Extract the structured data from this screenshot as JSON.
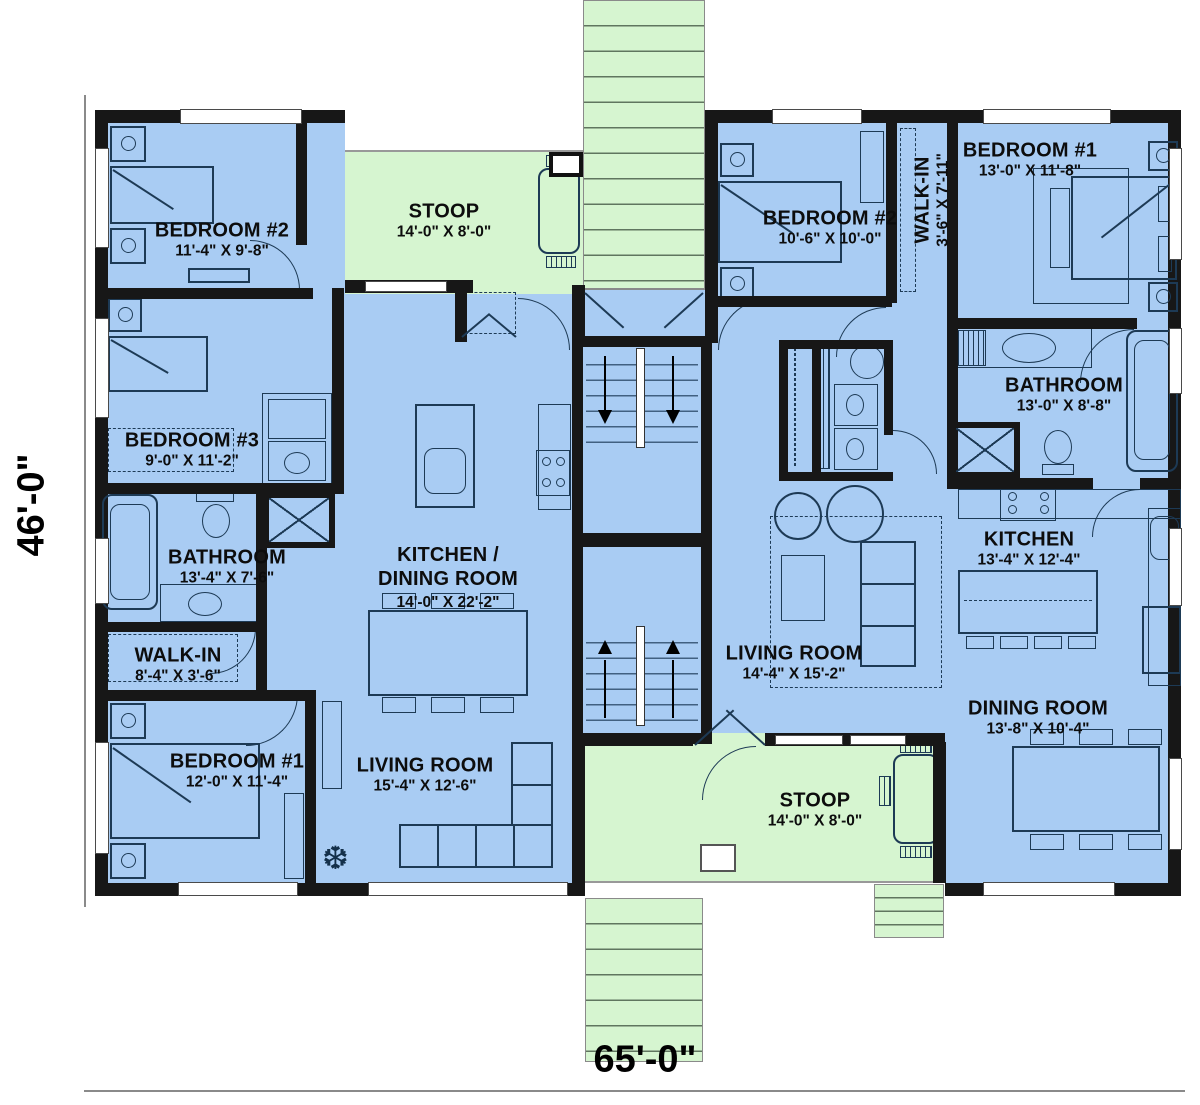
{
  "plan": {
    "overall_width_label": "65'-0\"",
    "overall_height_label": "46'-0\"",
    "left_unit": {
      "bedroom2": {
        "name": "BEDROOM #2",
        "dims": "11'-4\" X 9'-8\""
      },
      "bedroom3": {
        "name": "BEDROOM #3",
        "dims": "9'-0\" X 11'-2\""
      },
      "bathroom": {
        "name": "BATHROOM",
        "dims": "13'-4\" X 7'-6\""
      },
      "walk_in": {
        "name": "WALK-IN",
        "dims": "8'-4\" X 3'-6\""
      },
      "bedroom1": {
        "name": "BEDROOM #1",
        "dims": "12'-0\" X 11'-4\""
      },
      "kitchen_dining": {
        "name_line1": "KITCHEN /",
        "name_line2": "DINING ROOM",
        "dims": "14'-0\" X 22'-2\""
      },
      "living": {
        "name": "LIVING ROOM",
        "dims": "15'-4\" X 12'-6\""
      },
      "stoop": {
        "name": "STOOP",
        "dims": "14'-0\" X 8'-0\""
      }
    },
    "right_unit": {
      "bedroom2": {
        "name": "BEDROOM #2",
        "dims": "10'-6\" X 10'-0\""
      },
      "walk_in": {
        "name": "WALK-IN",
        "dims": "3'-6\" X 7'-11\""
      },
      "bedroom1": {
        "name": "BEDROOM #1",
        "dims": "13'-0\" X 11'-8\""
      },
      "bathroom": {
        "name": "BATHROOM",
        "dims": "13'-0\" X 8'-8\""
      },
      "living": {
        "name": "LIVING ROOM",
        "dims": "14'-4\" X 15'-2\""
      },
      "kitchen": {
        "name": "KITCHEN",
        "dims": "13'-4\" X 12'-4\""
      },
      "dining": {
        "name": "DINING ROOM",
        "dims": "13'-8\" X 10'-4\""
      },
      "stoop": {
        "name": "STOOP",
        "dims": "14'-0\" X 8'-0\""
      }
    },
    "icons": {
      "plant_glyph": "❆"
    },
    "palette": {
      "room_fill": "#a9ccf3",
      "stoop_fill": "#d6f5d0",
      "wall": "#171717",
      "furniture_line": "#1d3a55"
    }
  }
}
